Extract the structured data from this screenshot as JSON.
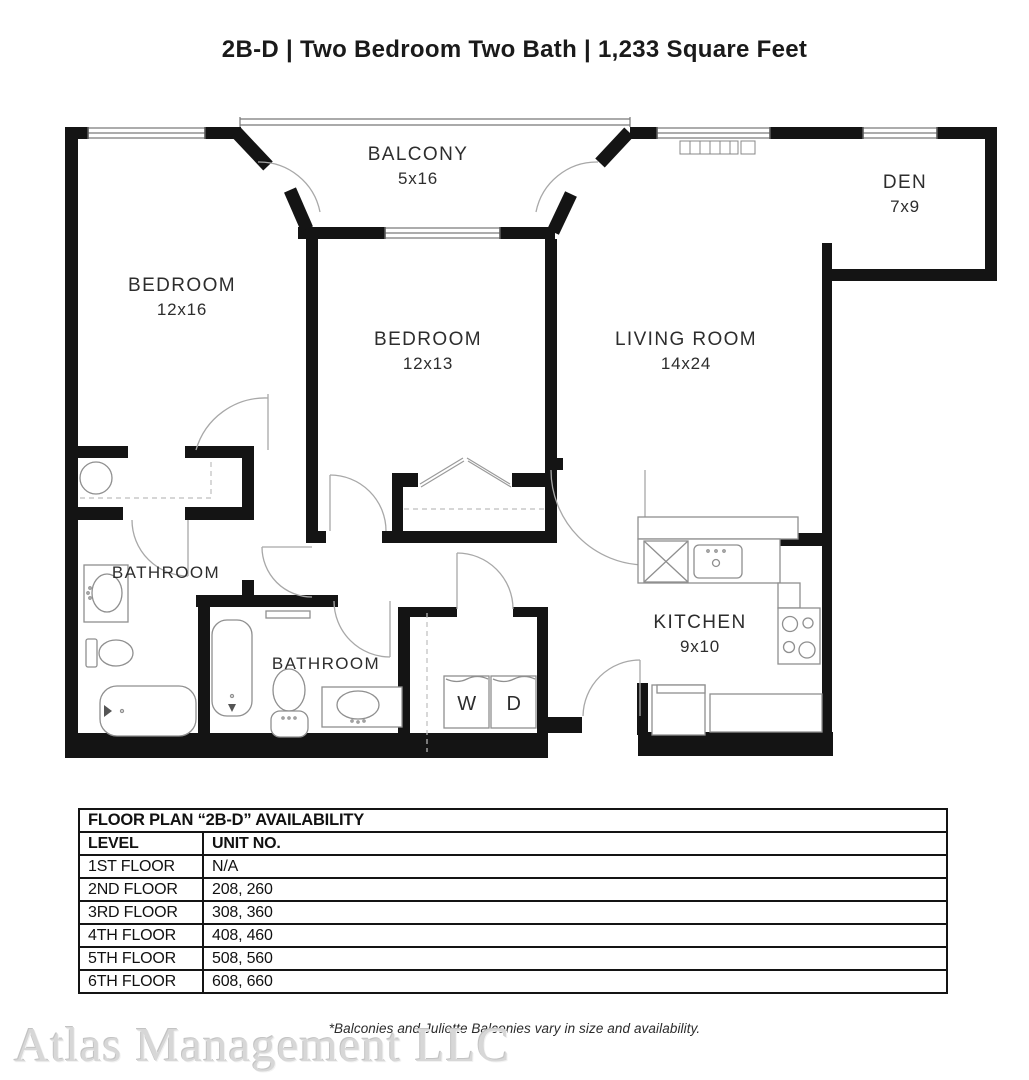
{
  "title": "2B-D | Two Bedroom Two Bath | 1,233 Square Feet",
  "rooms": [
    {
      "id": "balcony",
      "name": "BALCONY",
      "dims": "5x16"
    },
    {
      "id": "bedroom-left",
      "name": "BEDROOM",
      "dims": "12x16"
    },
    {
      "id": "bedroom-middle",
      "name": "BEDROOM",
      "dims": "12x13"
    },
    {
      "id": "living-room",
      "name": "LIVING ROOM",
      "dims": "14x24"
    },
    {
      "id": "den",
      "name": "DEN",
      "dims": "7x9"
    },
    {
      "id": "kitchen",
      "name": "KITCHEN",
      "dims": "9x10"
    },
    {
      "id": "bathroom-left",
      "name": "BATHROOM",
      "dims": ""
    },
    {
      "id": "bathroom-middle",
      "name": "BATHROOM",
      "dims": ""
    }
  ],
  "laundry": {
    "washer": "W",
    "dryer": "D"
  },
  "availability_table": {
    "title": "FLOOR PLAN “2B-D” AVAILABILITY",
    "columns": [
      "LEVEL",
      "UNIT NO."
    ],
    "rows": [
      {
        "level": "1ST FLOOR",
        "units": "N/A"
      },
      {
        "level": "2ND FLOOR",
        "units": "208, 260"
      },
      {
        "level": "3RD FLOOR",
        "units": "308, 360"
      },
      {
        "level": "4TH FLOOR",
        "units": "408, 460"
      },
      {
        "level": "5TH FLOOR",
        "units": "508, 560"
      },
      {
        "level": "6TH FLOOR",
        "units": "608, 660"
      }
    ]
  },
  "footnote": "*Balconies and Juliette Balconies vary in size and availability.",
  "watermark": "Atlas Management LLC",
  "colors": {
    "wall": "#141414",
    "fixture_line": "#8f8f8f",
    "door_arc": "#a8a8a8",
    "dashed": "#bdbdbd",
    "label": "#2d2d2d",
    "watermark": "#d7d7d7"
  }
}
